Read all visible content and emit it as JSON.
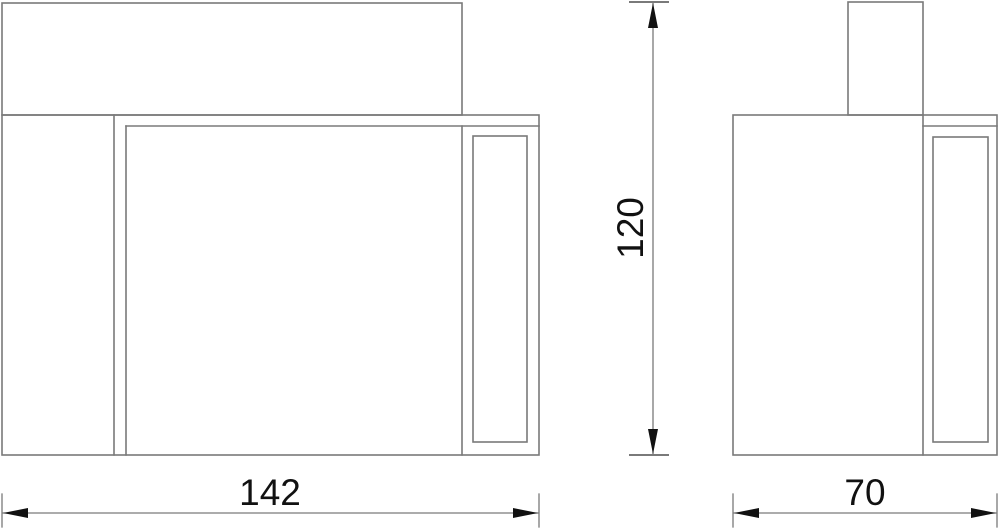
{
  "drawing": {
    "dimension_labels": {
      "width": "142",
      "height": "120",
      "depth": "70"
    },
    "colors": {
      "background": "#ffffff",
      "line": "#7a7a7a",
      "dimension_line": "#7a7a7a",
      "arrow": "#111111",
      "text": "#111111"
    }
  }
}
